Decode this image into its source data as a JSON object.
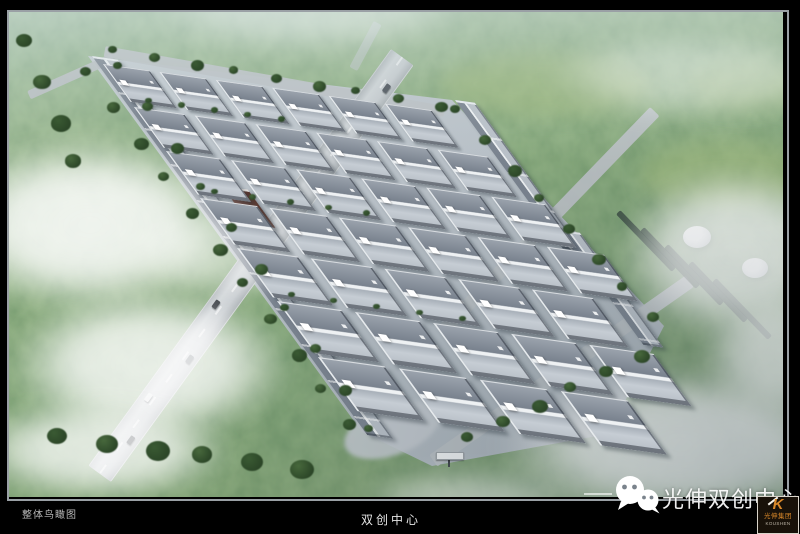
{
  "captions": {
    "left": "整体鸟瞰图",
    "center": "双创中心"
  },
  "watermark": {
    "text": "光伸双创中心"
  },
  "logo": {
    "letter": "K",
    "company_cn": "光伸集团",
    "company_en": "KOUSHEN",
    "accent_color": "#d8882a"
  },
  "colors": {
    "frame_border": "#9aa0a5",
    "forest_green": "#4c6b43",
    "haze": "#d2e0e0",
    "pavement": "#b7bfc6",
    "roof_dark": "#79828e",
    "roof_light": "#c6cdd4",
    "cloud": "#ffffff"
  }
}
